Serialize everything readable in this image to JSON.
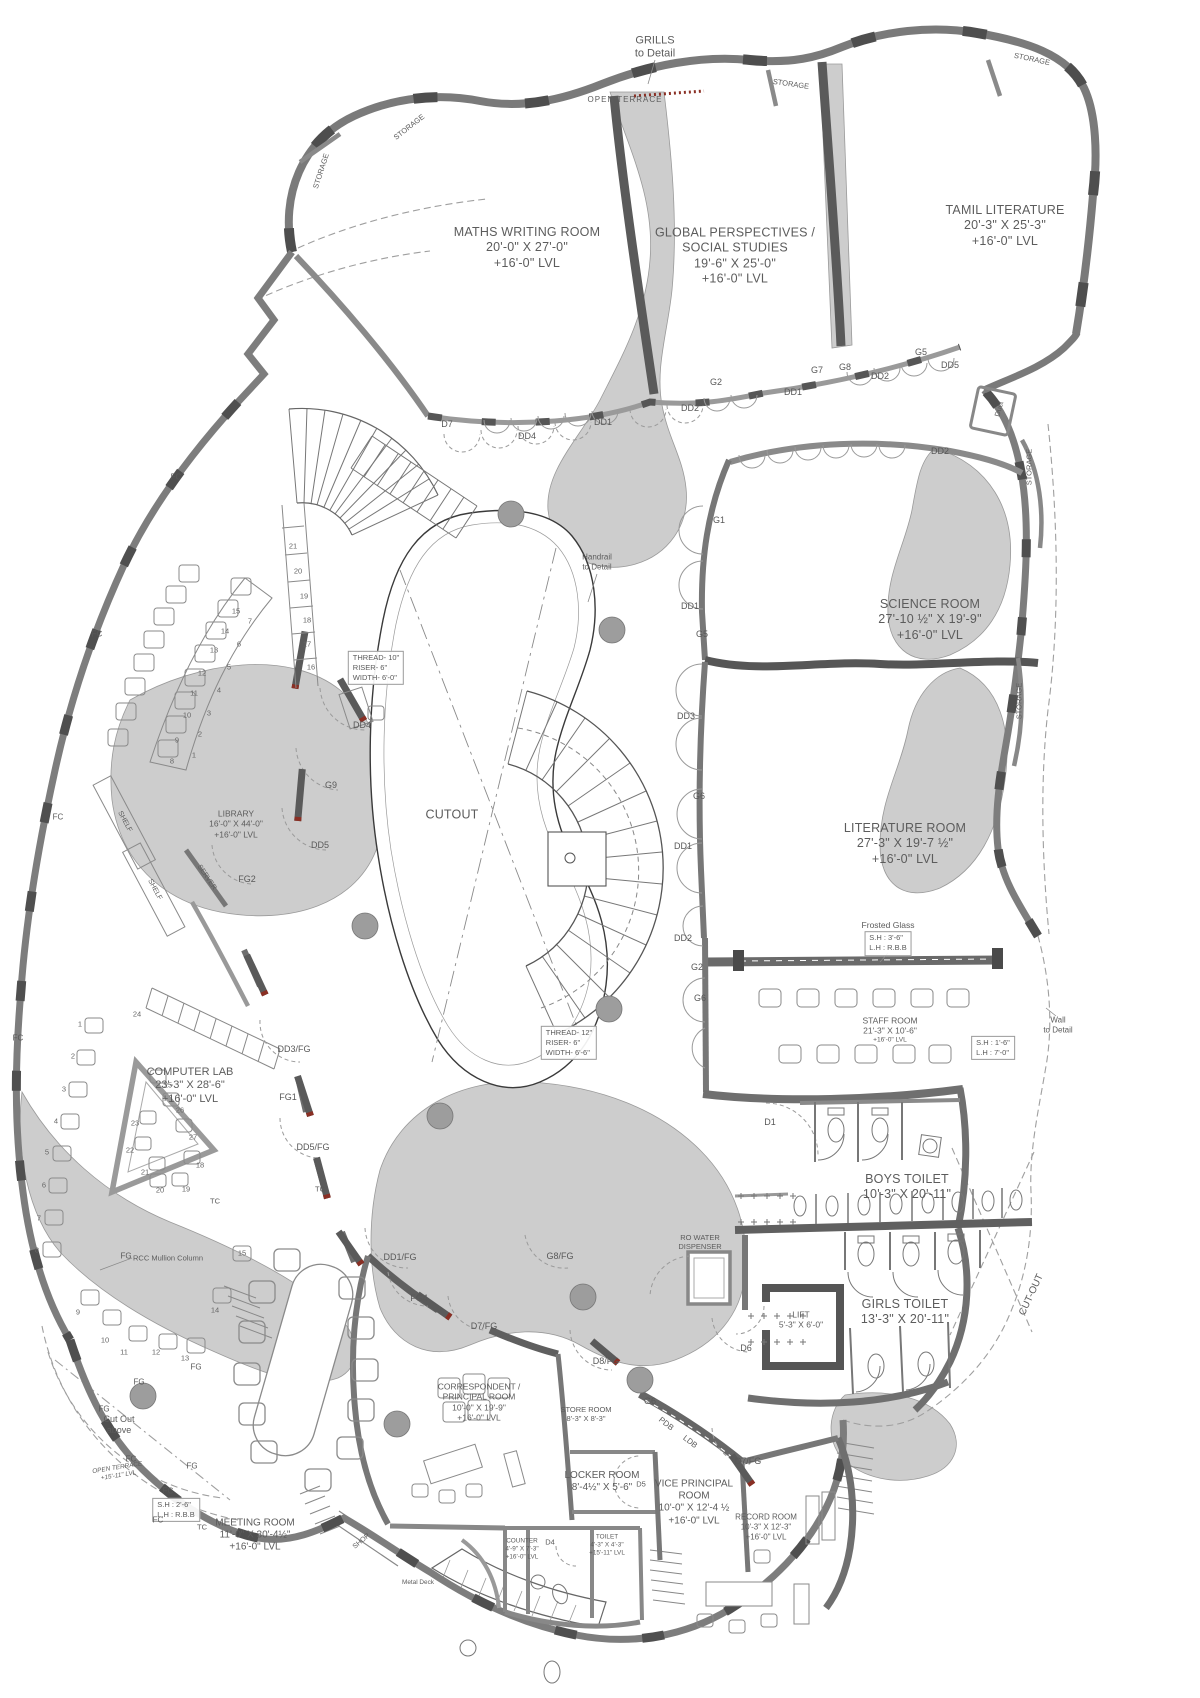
{
  "rooms": {
    "maths": {
      "name": "MATHS WRITING ROOM",
      "dims": "20'-0\" X 27'-0\"",
      "level": "+16'-0\" LVL"
    },
    "global": {
      "name1": "GLOBAL PERSPECTIVES /",
      "name2": "SOCIAL STUDIES",
      "dims": "19'-6\" X 25'-0\"",
      "level": "+16'-0\" LVL"
    },
    "tamil": {
      "name": "TAMIL LITERATURE",
      "dims": "20'-3\" X 25'-3\"",
      "level": "+16'-0\" LVL"
    },
    "science": {
      "name": "SCIENCE ROOM",
      "dims": "27'-10 ½\" X 19'-9\"",
      "level": "+16'-0\" LVL"
    },
    "literature": {
      "name": "LITERATURE ROOM",
      "dims": "27'-3\" X 19'-7 ½\"",
      "level": "+16'-0\" LVL"
    },
    "library": {
      "name": "LIBRARY",
      "dims": "16'-0\" X 44'-0\"",
      "level": "+16'-0\" LVL"
    },
    "computer": {
      "name": "COMPUTER LAB",
      "dims": "23'-3\" X 28'-6\"",
      "level": "+16'-0\" LVL"
    },
    "staff": {
      "name": "STAFF ROOM",
      "dims": "21'-3\" X 10'-6\"",
      "level": "+16'-0\" LVL"
    },
    "boys": {
      "name": "BOYS TOILET",
      "dims": "10'-3\" X 20'-11\""
    },
    "girls": {
      "name": "GIRLS TOILET",
      "dims": "13'-3\" X 20'-11\""
    },
    "lift": {
      "name": "LIFT",
      "dims": "5'-3\" X 6'-0\""
    },
    "meeting": {
      "name": "MEETING ROOM",
      "dims": "11'-0\" X 30'-4½\"",
      "level": "+16'-0\" LVL"
    },
    "correspondent": {
      "name1": "CORRESPONDENT /",
      "name2": "PRINCIPAL ROOM",
      "dims": "10'-0\" X 19'-9\"",
      "level": "+16'-0\" LVL"
    },
    "store": {
      "name": "STORE ROOM",
      "dims": "8'-3\" X 8'-3\""
    },
    "locker": {
      "name": "LOCKER ROOM",
      "dims": "8'-4½\" X 5'-6\""
    },
    "vice": {
      "name1": "VICE PRINCIPAL",
      "name2": "ROOM",
      "dims": "10'-0\" X 12'-4 ½",
      "level": "+16'-0\" LVL"
    },
    "record": {
      "name": "RECORD ROOM",
      "dims": "10'-3\" X 12'-3\"",
      "level": "+16'-0\" LVL"
    },
    "counter": {
      "name": "COUNTER",
      "dims": "4'-9\" X 7'-3\"",
      "level": "+16'-0\" LVL"
    },
    "toilet_small": {
      "name": "TOILET",
      "dims": "4'-3\" X 4'-3\"",
      "level": "+15'-11\" LVL"
    },
    "cutout": {
      "name": "CUTOUT"
    },
    "terrace_top": {
      "name": "OPEN TERRACE"
    },
    "terrace_low": {
      "name": "OPEN TERRACE",
      "level": "+15'-11\" LVL"
    }
  },
  "notes": {
    "grills": {
      "l1": "GRILLS",
      "l2": "to Detail"
    },
    "handrail": {
      "l1": "Handrail",
      "l2": "to Detail"
    },
    "wall": {
      "l1": "Wall",
      "l2": "to Detail"
    },
    "stair_upper": {
      "l1": "THREAD- 10\"",
      "l2": "RISER- 6\"",
      "l3": "WIDTH- 6'-0\""
    },
    "stair_lower": {
      "l1": "THREAD- 12\"",
      "l2": "RISER- 6\"",
      "l3": "WIDTH- 6'-6\""
    },
    "frosted": {
      "title": "Frosted Glass",
      "l1": "S.H : 3'-6\"",
      "l2": "L.H : R.B.B"
    },
    "staff_sill": {
      "l1": "S.H : 1'-6\"",
      "l2": "L.H : 7'-0\""
    },
    "meeting_sill": {
      "l1": "S.H : 2'-6\"",
      "l2": "L.H : R.B.B"
    },
    "ro_water": {
      "l1": "RO WATER",
      "l2": "DISPENSER"
    },
    "rcc": "RCC Mullion Column",
    "cutout_above": {
      "l1": "Cut Out",
      "l2": "above"
    },
    "cutout_right": "CUT-OUT",
    "metal_deck": "Metal Deck",
    "duct": "Duct",
    "pdb": "PDB",
    "ldb": "LDB",
    "shop": "SHOP",
    "storage": "STORAGE",
    "shelf": "SHELF",
    "server": "SERVER"
  },
  "tags": [
    "D7",
    "DD4",
    "DD1",
    "DD2",
    "G2",
    "DD1",
    "G7",
    "G8",
    "DD2",
    "G5",
    "DD5",
    "DD2",
    "G1",
    "DD1",
    "G5",
    "DD3",
    "G6",
    "DD1",
    "DD2",
    "G2",
    "G6",
    "D1",
    "D6",
    "DD4",
    "G9",
    "DD5",
    "FG2",
    "DD3/FG",
    "FG1",
    "DD5/FG",
    "TC",
    "TC",
    "DD1/FG",
    "FG4",
    "D7/FG",
    "G8/FG",
    "D8/FG",
    "G6",
    "D7/FG",
    "D5",
    "D4",
    "TC",
    "FC",
    "FC",
    "FC",
    "FC",
    "FC",
    "FC",
    "FC",
    "FG",
    "FG",
    "FG",
    "FG",
    "FG"
  ],
  "numbers": {
    "lib_col": [
      "21",
      "20",
      "19",
      "18",
      "17",
      "16"
    ],
    "lib_in": [
      "15",
      "14",
      "13",
      "12",
      "11",
      "10",
      "9",
      "8"
    ],
    "lib_out": [
      "7",
      "6",
      "5",
      "4",
      "3",
      "2",
      "1"
    ],
    "cl_left": [
      "1",
      "2",
      "3",
      "4",
      "5",
      "6",
      "7",
      "8"
    ],
    "cl_arc": [
      "9",
      "10",
      "11",
      "12",
      "13",
      "14",
      "15"
    ],
    "cl_tri": [
      "25",
      "26",
      "27",
      "23",
      "22",
      "21",
      "18",
      "19",
      "20"
    ],
    "cl_24": "24"
  }
}
